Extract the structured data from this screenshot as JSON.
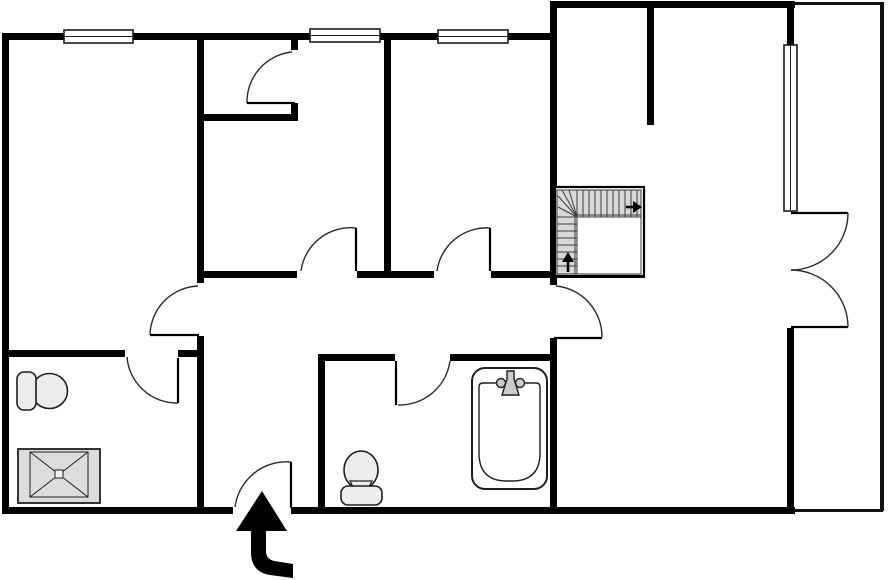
{
  "canvas": {
    "width": 894,
    "height": 580,
    "background": "#ffffff"
  },
  "palette": {
    "wall": "#000000",
    "leaf": "#000000",
    "arc": "#2b2b2b",
    "window_stroke": "#1a1a1a",
    "window_fill": "#ffffff",
    "balcony_line": "#111111",
    "fixture_fill": "#ececec",
    "fixture_stroke": "#1f1f1f",
    "shower_fill": "#dcdcdc",
    "faucet_fill": "#cccccc",
    "stair_fill": "#d8d8d8",
    "stair_line": "#3c3c3c",
    "arrow_fill": "#000000"
  },
  "walls": [
    {
      "name": "wall-outer-left",
      "x": 2,
      "y": 33,
      "w": 7,
      "h": 481
    },
    {
      "name": "wall-outer-top-left",
      "x": 2,
      "y": 33,
      "w": 553,
      "h": 7
    },
    {
      "name": "wall-outer-top-right",
      "x": 550,
      "y": 1,
      "w": 245,
      "h": 7
    },
    {
      "name": "wall-outer-bottom-left",
      "x": 2,
      "y": 507,
      "w": 231,
      "h": 7
    },
    {
      "name": "wall-outer-bottom-right",
      "x": 291,
      "y": 507,
      "w": 504,
      "h": 7
    },
    {
      "name": "wall-living-left-upper",
      "x": 550,
      "y": 1,
      "w": 7,
      "h": 284
    },
    {
      "name": "wall-living-left-lower",
      "x": 550,
      "y": 338,
      "w": 7,
      "h": 176
    },
    {
      "name": "wall-balcony-stub-top",
      "x": 787,
      "y": 1,
      "w": 7,
      "h": 44
    },
    {
      "name": "wall-balcony-lower",
      "x": 787,
      "y": 328,
      "w": 7,
      "h": 186
    },
    {
      "name": "wall-bedroom1-right-upper",
      "x": 197,
      "y": 33,
      "w": 7,
      "h": 250
    },
    {
      "name": "wall-bedroom1-right-lower",
      "x": 197,
      "y": 336,
      "w": 7,
      "h": 178
    },
    {
      "name": "wall-closet-bottom",
      "x": 197,
      "y": 114,
      "w": 101,
      "h": 7
    },
    {
      "name": "wall-closet-stub-top",
      "x": 291,
      "y": 33,
      "w": 7,
      "h": 17
    },
    {
      "name": "wall-closet-stub-bottom",
      "x": 291,
      "y": 103,
      "w": 7,
      "h": 18
    },
    {
      "name": "wall-bedroom-divider",
      "x": 384,
      "y": 33,
      "w": 7,
      "h": 245
    },
    {
      "name": "wall-hallway-top-1",
      "x": 197,
      "y": 271,
      "w": 100,
      "h": 7
    },
    {
      "name": "wall-hallway-top-2",
      "x": 357,
      "y": 271,
      "w": 77,
      "h": 7
    },
    {
      "name": "wall-hallway-top-3",
      "x": 491,
      "y": 271,
      "w": 154,
      "h": 7
    },
    {
      "name": "wall-stair-right",
      "x": 637,
      "y": 187,
      "w": 7,
      "h": 91
    },
    {
      "name": "wall-living-stub",
      "x": 647,
      "y": 1,
      "w": 7,
      "h": 124
    },
    {
      "name": "wall-bath-left-top-1",
      "x": 2,
      "y": 350,
      "w": 123,
      "h": 7
    },
    {
      "name": "wall-bath-left-top-2",
      "x": 178,
      "y": 350,
      "w": 26,
      "h": 7
    },
    {
      "name": "wall-vestibule-right",
      "x": 318,
      "y": 357,
      "w": 7,
      "h": 157
    },
    {
      "name": "wall-bath-mid-top-1",
      "x": 318,
      "y": 354,
      "w": 77,
      "h": 7
    },
    {
      "name": "wall-bath-mid-top-2",
      "x": 450,
      "y": 354,
      "w": 107,
      "h": 7
    }
  ],
  "balcony_lines": [
    {
      "name": "balcony-edge-top",
      "x": 793,
      "y": 2,
      "w": 90,
      "h": 3
    },
    {
      "name": "balcony-edge-right",
      "x": 880,
      "y": 2,
      "w": 4,
      "h": 509
    },
    {
      "name": "balcony-edge-bottom",
      "x": 793,
      "y": 509,
      "w": 90,
      "h": 3
    }
  ],
  "windows": [
    {
      "name": "window-bedroom1",
      "x": 64,
      "y": 30,
      "w": 69,
      "h": 13,
      "orient": "h"
    },
    {
      "name": "window-bedroom2",
      "x": 310,
      "y": 29,
      "w": 70,
      "h": 13,
      "orient": "h"
    },
    {
      "name": "window-bedroom3",
      "x": 438,
      "y": 30,
      "w": 70,
      "h": 13,
      "orient": "h"
    },
    {
      "name": "window-living",
      "x": 784,
      "y": 45,
      "w": 13,
      "h": 166,
      "orient": "v"
    }
  ],
  "doors": [
    {
      "name": "door-closet",
      "leaf": [
        295,
        103,
        247,
        103
      ],
      "arc": [
        247,
        103,
        50,
        1,
        292,
        52
      ]
    },
    {
      "name": "door-bedroom1",
      "leaf": [
        199,
        335,
        150,
        335
      ],
      "arc": [
        150,
        335,
        50,
        1,
        198,
        286
      ]
    },
    {
      "name": "door-bedroom2",
      "leaf": [
        356,
        271,
        356,
        228
      ],
      "arc": [
        301,
        271,
        50,
        1,
        356,
        228
      ]
    },
    {
      "name": "door-bedroom3",
      "leaf": [
        490,
        271,
        490,
        228
      ],
      "arc": [
        437,
        271,
        50,
        1,
        490,
        228
      ]
    },
    {
      "name": "door-living-room",
      "leaf": [
        554,
        338,
        602,
        338
      ],
      "arc": [
        556,
        286,
        51,
        1,
        602,
        337
      ]
    },
    {
      "name": "door-bath-left",
      "leaf": [
        178,
        358,
        178,
        403
      ],
      "arc": [
        127,
        357,
        50,
        0,
        178,
        403
      ]
    },
    {
      "name": "door-bath-mid",
      "leaf": [
        396,
        361,
        396,
        405
      ],
      "arc": [
        398,
        405,
        51,
        0,
        450,
        361
      ]
    },
    {
      "name": "door-entrance",
      "leaf": [
        291,
        508,
        291,
        462
      ],
      "arc": [
        235,
        507,
        52,
        1,
        291,
        462
      ]
    },
    {
      "name": "door-balcony-upper",
      "leaf": [
        791,
        213,
        848,
        213
      ],
      "arc": [
        848,
        213,
        57,
        1,
        791,
        270
      ]
    },
    {
      "name": "door-balcony-lower",
      "leaf": [
        791,
        327,
        848,
        327
      ],
      "arc": [
        848,
        327,
        57,
        0,
        791,
        270
      ]
    }
  ],
  "stairs": {
    "name": "staircase",
    "box": {
      "x": 555,
      "y": 187,
      "w": 89,
      "h": 89
    },
    "tread_regions": [
      {
        "x": 557,
        "y": 190,
        "w": 84,
        "h": 27
      },
      {
        "x": 557,
        "y": 217,
        "w": 20,
        "h": 57
      }
    ],
    "void": {
      "x": 577,
      "y": 217,
      "w": 64,
      "h": 57
    },
    "tread_lines": [
      [
        583,
        190,
        583,
        217
      ],
      [
        589,
        190,
        589,
        217
      ],
      [
        595,
        190,
        595,
        217
      ],
      [
        601,
        190,
        601,
        217
      ],
      [
        607,
        190,
        607,
        217
      ],
      [
        613,
        190,
        613,
        217
      ],
      [
        619,
        190,
        619,
        217
      ],
      [
        625,
        190,
        625,
        217
      ],
      [
        631,
        190,
        631,
        217
      ],
      [
        637,
        190,
        637,
        217
      ],
      [
        577,
        215,
        641,
        215
      ],
      [
        577,
        190,
        577,
        217
      ],
      [
        577,
        217,
        558,
        207
      ],
      [
        577,
        217,
        558,
        196
      ],
      [
        577,
        217,
        562,
        190
      ],
      [
        577,
        217,
        569,
        190
      ],
      [
        557,
        224,
        577,
        224
      ],
      [
        557,
        231,
        577,
        231
      ],
      [
        557,
        238,
        577,
        238
      ],
      [
        557,
        245,
        577,
        245
      ],
      [
        557,
        252,
        577,
        252
      ],
      [
        557,
        259,
        577,
        259
      ],
      [
        557,
        266,
        577,
        266
      ],
      [
        575,
        217,
        575,
        274
      ]
    ],
    "arrows": [
      {
        "name": "stair-arrow-up",
        "line": [
          568,
          272,
          568,
          261
        ],
        "head": "M562,262 L574,262 L568,252 Z"
      },
      {
        "name": "stair-arrow-right",
        "line": [
          626,
          207,
          634,
          207
        ],
        "head": "M633,201 L633,213 L642,207 Z"
      }
    ]
  },
  "fixtures": [
    {
      "name": "toilet-icon-left-bathroom",
      "shapes": [
        {
          "type": "ellipse",
          "cx": 49.5,
          "cy": 391,
          "rx": 18,
          "ry": 17.5,
          "fill": "fixture_fill",
          "sw": 1.6
        },
        {
          "type": "rect",
          "x": 17,
          "y": 372,
          "w": 19,
          "h": 38,
          "rx": 7,
          "fill": "fixture_fill",
          "sw": 1.6
        },
        {
          "type": "line",
          "x1": 36,
          "y1": 381,
          "x2": 36,
          "y2": 401,
          "sw": 1.2
        }
      ]
    },
    {
      "name": "shower-icon",
      "shapes": [
        {
          "type": "rect",
          "x": 18,
          "y": 449,
          "w": 82,
          "h": 54,
          "fill": "shower_fill",
          "sw": 1.8
        },
        {
          "type": "rect",
          "x": 30,
          "y": 452,
          "w": 58,
          "h": 45,
          "fill": "shower_fill",
          "sw": 1
        },
        {
          "type": "line",
          "x1": 30,
          "y1": 452,
          "x2": 88,
          "y2": 497,
          "sw": 1
        },
        {
          "type": "line",
          "x1": 88,
          "y1": 452,
          "x2": 30,
          "y2": 497,
          "sw": 1
        },
        {
          "type": "rect",
          "x": 55,
          "y": 470,
          "w": 8,
          "h": 8,
          "fill": "#f2f2f2",
          "sw": 1
        }
      ]
    },
    {
      "name": "toilet-icon-mid-bathroom",
      "shapes": [
        {
          "type": "ellipse",
          "cx": 361,
          "cy": 470,
          "rx": 17,
          "ry": 19,
          "fill": "fixture_fill",
          "sw": 1.6
        },
        {
          "type": "path",
          "d": "M350,481 L372,481 L369,487 L353,487 Z",
          "fill": "fixture_fill",
          "sw": 1.2
        },
        {
          "type": "rect",
          "x": 341,
          "y": 486,
          "w": 41,
          "h": 19,
          "rx": 7,
          "fill": "fixture_fill",
          "sw": 1.6
        }
      ]
    },
    {
      "name": "bathtub-icon",
      "shapes": [
        {
          "type": "rect",
          "x": 472,
          "y": 368,
          "w": 75,
          "h": 121,
          "rx": 13,
          "fill": "#ffffff",
          "sw": 2
        },
        {
          "type": "path",
          "d": "M483,383 L536,383 Q540,383 540,387 L540,453 Q540,481 512,481 L507,481 Q479,481 479,453 L479,387 Q479,383 483,383 Z",
          "fill": "none",
          "sw": 1.4
        },
        {
          "type": "circle",
          "cx": 501,
          "cy": 383,
          "r": 4.5,
          "fill": "faucet_fill",
          "sw": 1.4
        },
        {
          "type": "circle",
          "cx": 520,
          "cy": 383,
          "r": 4.5,
          "fill": "faucet_fill",
          "sw": 1.4
        },
        {
          "type": "path",
          "d": "M507,371 L514,371 L514,379 L519,395 L502,395 L507,379 Z",
          "fill": "faucet_fill",
          "sw": 1.4
        }
      ]
    }
  ],
  "entrance_arrow": {
    "name": "entrance-arrow",
    "path": "M262,491 L236,531 L251,531 L251,552 Q251,572 270,575 L293,578 L293,564 L274,561 Q266,559 266,551 L266,531 L287,531 Z"
  }
}
